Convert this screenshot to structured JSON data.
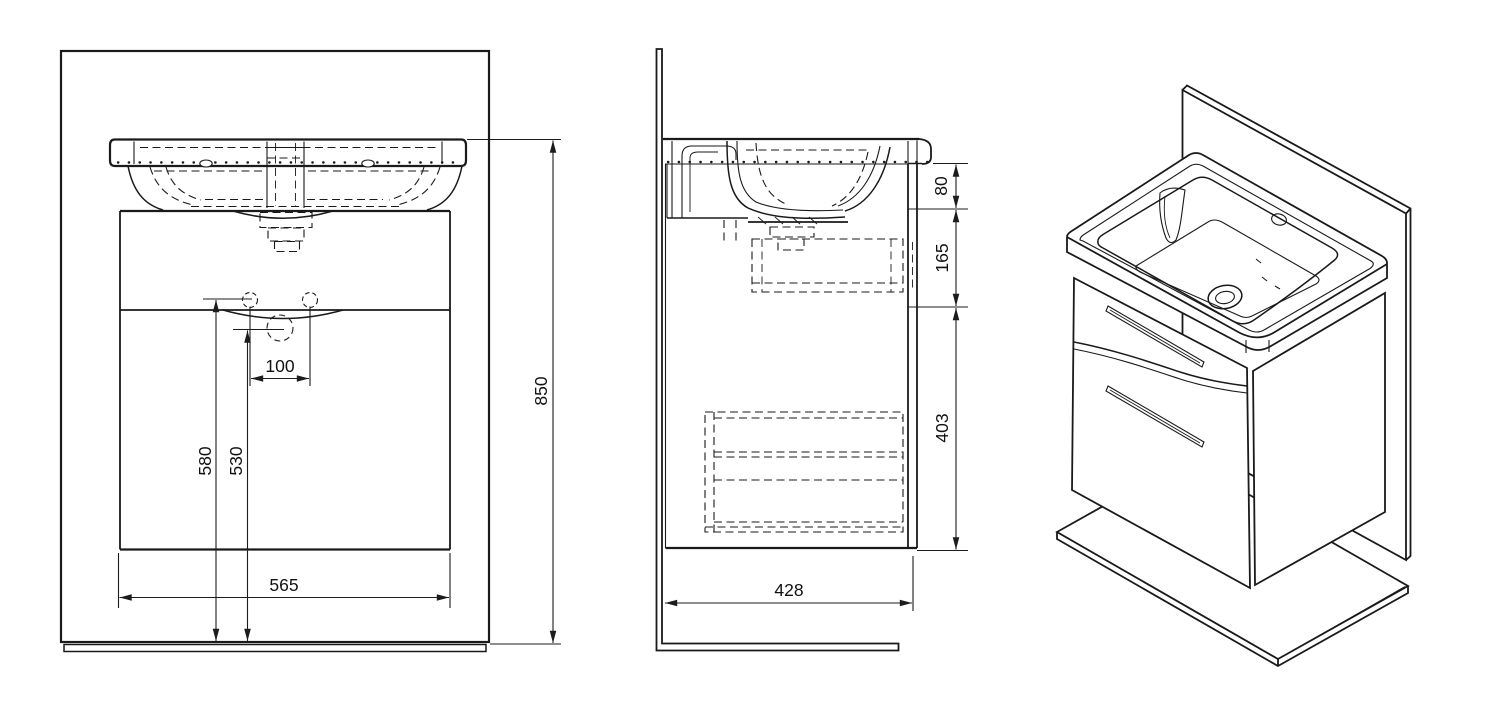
{
  "drawing": {
    "type": "technical-dimension-drawing",
    "subject": "washbasin vanity unit with cabinet, wall and floor panels",
    "views": [
      "front",
      "side",
      "isometric"
    ]
  },
  "dimensions": {
    "front_view": {
      "faucet_hole_spacing": "100",
      "floor_to_mount_holes": "580",
      "floor_to_siphon": "530",
      "cabinet_width": "565",
      "overall_height": "850"
    },
    "side_view": {
      "basin_section_height": "80",
      "upper_section_height": "165",
      "drawer_section_height": "403",
      "overall_depth": "428"
    }
  }
}
